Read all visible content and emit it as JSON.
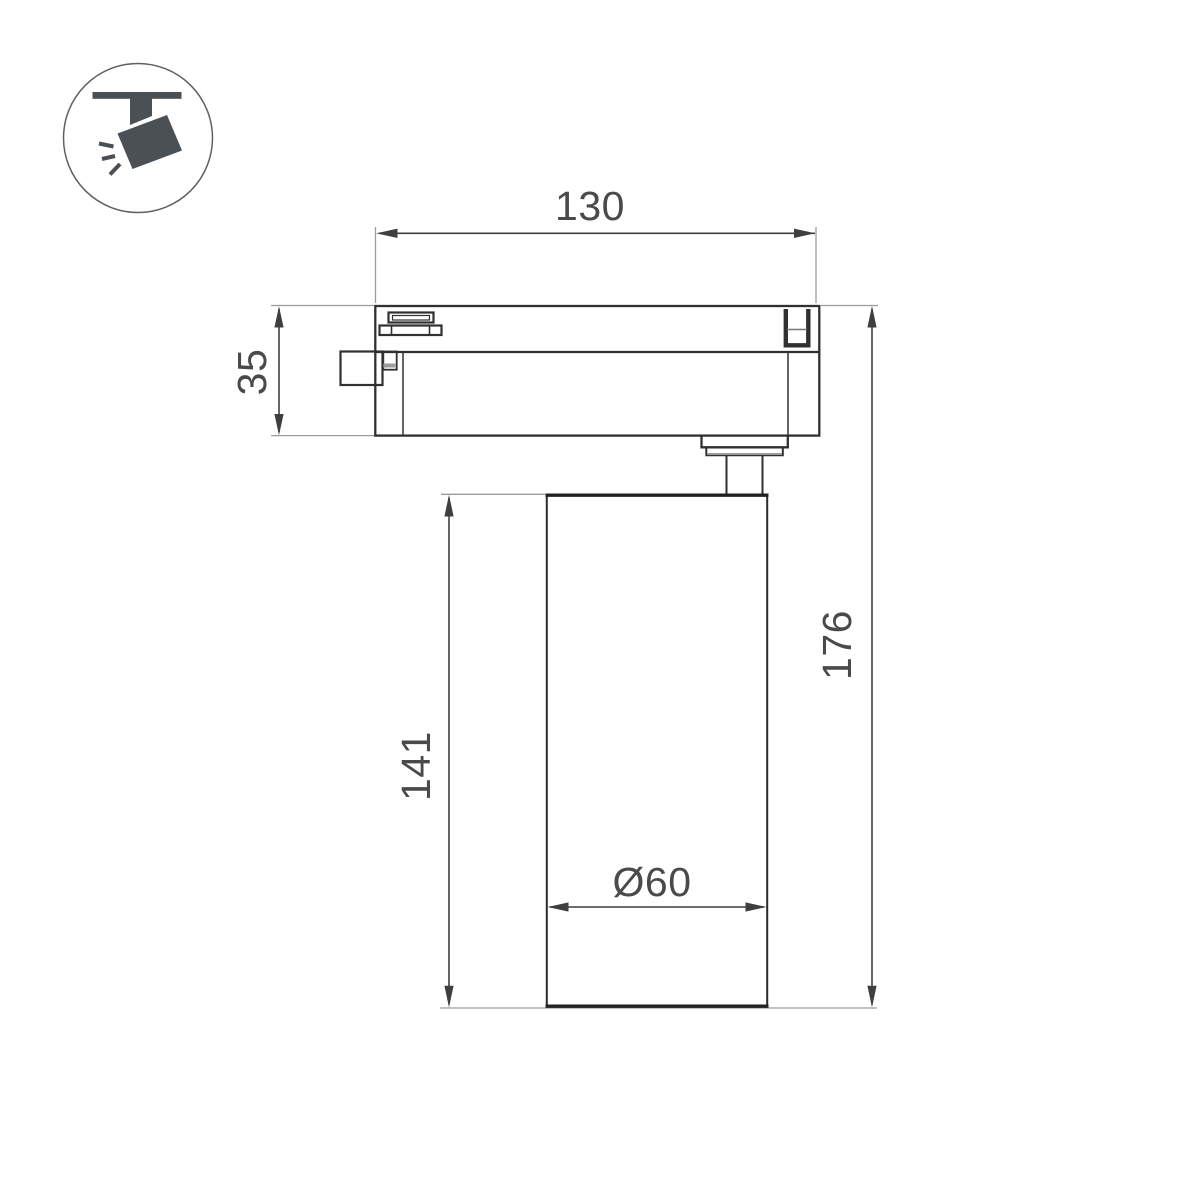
{
  "title": "Track spotlight dimension drawing",
  "icon": {
    "name": "track-spotlight-icon",
    "fill": "#4b5055",
    "circle_stroke": "#606060"
  },
  "colors": {
    "outline": "#303030",
    "heavy_edge": "#222222",
    "extension_line": "#9b9b9b",
    "dimension_line": "#3f3f3f",
    "text": "#4a4a4a",
    "background": "#ffffff"
  },
  "drawing": {
    "dimensions": {
      "track_adapter_width": "130",
      "track_adapter_height": "35",
      "body_height": "141",
      "overall_height": "176",
      "body_diameter": "Ø60"
    }
  }
}
